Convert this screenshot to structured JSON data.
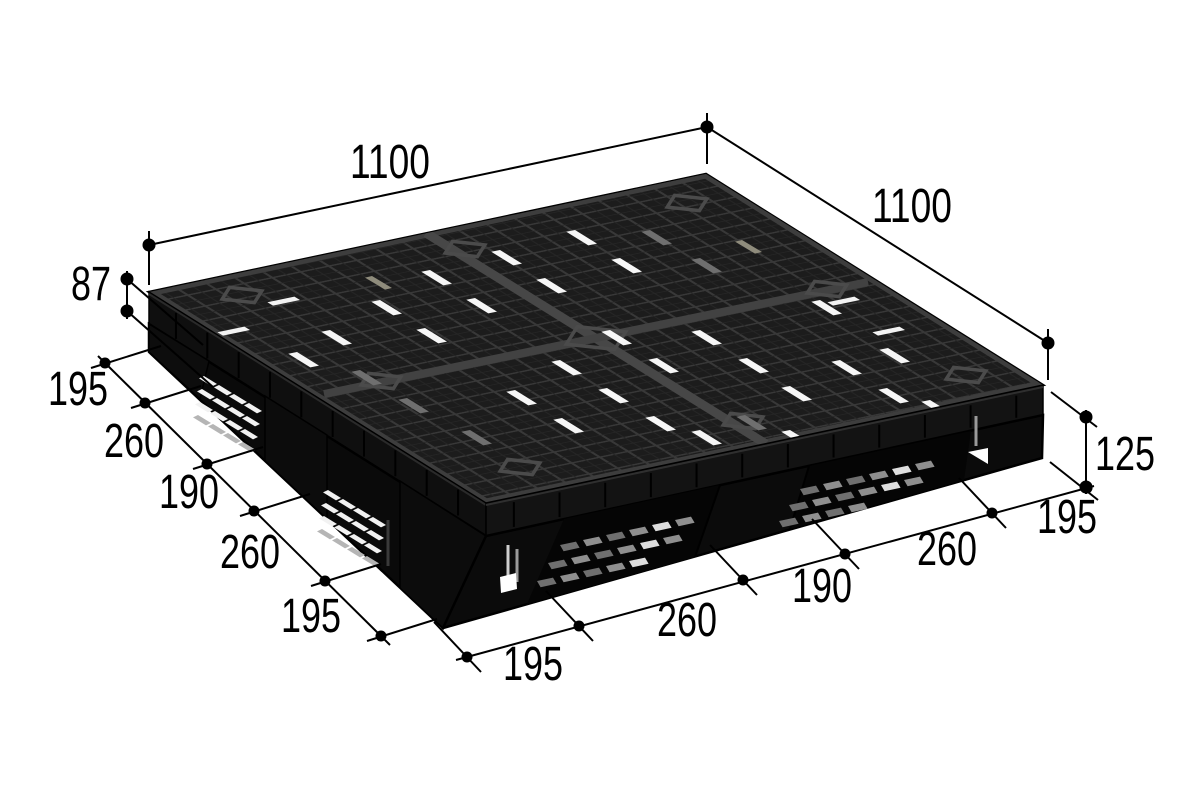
{
  "page": {
    "background": "#ffffff",
    "subject": "plastic-pallet-isometric-dimension-drawing"
  },
  "dims": {
    "top_width": "1100",
    "right_width": "1100",
    "deck_thickness": "87",
    "overall_height": "125",
    "left_chain": [
      "195",
      "260",
      "190",
      "260",
      "195"
    ],
    "bottom_chain": [
      "195",
      "260",
      "190",
      "260",
      "195"
    ]
  },
  "colors": {
    "dimension_line": "#000000",
    "pallet_top": "#1c1c1c",
    "pallet_side": "#0b0b0b",
    "rib_highlight": "#4a4a4a",
    "slot_light": "#f2f2f2",
    "slot_gray": "#8f8f8f",
    "pad_beige": "#8f8c7c"
  }
}
